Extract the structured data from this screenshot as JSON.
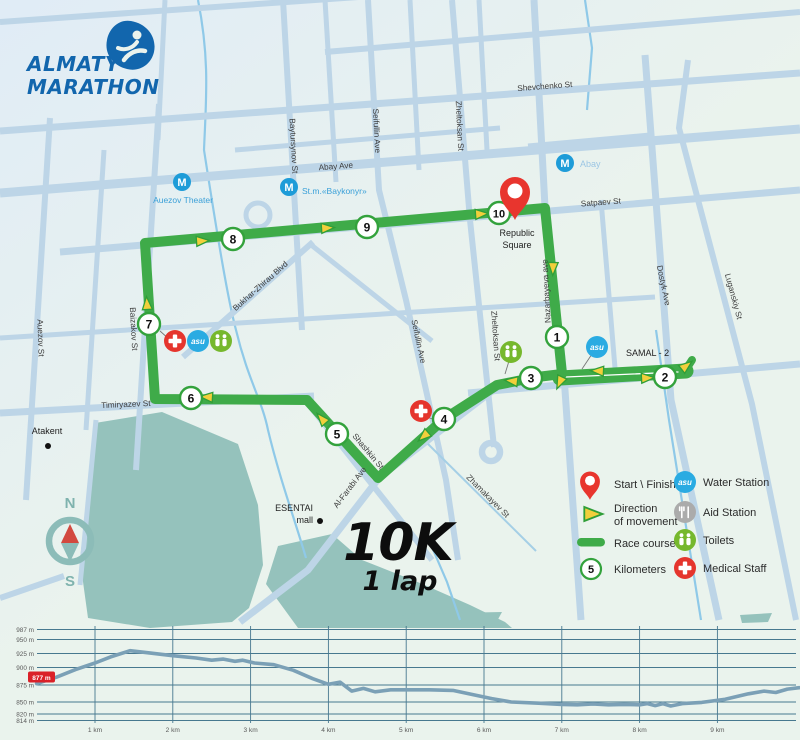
{
  "colors": {
    "background": "#eaf3ed",
    "background_tint": "#e2edf6",
    "street": "#bdd5e7",
    "river": "#8fc9e8",
    "park": "#95c2bc",
    "course_green": "#3fab49",
    "arrow_yellow": "#f2cf3b",
    "pin_red": "#e8352e",
    "medical_red": "#e5352d",
    "water_blue": "#2aabe2",
    "toilets_green": "#76b82d",
    "aid_gray": "#ababab",
    "metro_blue": "#1e9cd8",
    "logo_blue": "#1266ad",
    "chart_line": "#7ba0b6",
    "chart_grid": "#47788f"
  },
  "logo": {
    "line1": "ALMATY",
    "line2": "MARATHON"
  },
  "race": {
    "distance": "10K",
    "laps": "1 lap"
  },
  "compass": {
    "north": "N",
    "south": "S"
  },
  "icons": {
    "metro": "M",
    "asu": "asu"
  },
  "map": {
    "km_markers": [
      "1",
      "2",
      "3",
      "4",
      "5",
      "6",
      "7",
      "8",
      "9",
      "10"
    ],
    "start_area": {
      "line1": "Republic",
      "line2": "Square"
    },
    "streets": {
      "shevchenko": "Shevchenko St",
      "abay": "Abay Ave",
      "satpaev": "Satpaev St",
      "timiryazev": "Timiryazev St",
      "baytursynov": "Baytursynov St",
      "auezov": "Auezov St",
      "baizakov": "Baizakov St",
      "seifullin": "Seifullin Ave",
      "seifullin2": "Seifullin Ave",
      "zheltoksan": "Zheltoksan St",
      "zheltoksan2": "Zheltoksan St",
      "nazarbayeva": "Nazarbayeva ave",
      "dostyk": "Dostyk Ave",
      "luganskiy": "Luganskiy St",
      "bukhar_zhyrau": "Bukhar-Zhirau Blvd",
      "shashkin": "Shashkin St",
      "al_farabi": "Al-Farabi Ave",
      "zhamakayev": "Zhamakayev St"
    },
    "landmarks": {
      "auezov_theater": "Auezov Theater",
      "baykonyr": "St.m.«Baykonyr»",
      "abay_metro": "Abay",
      "atakent": "Atakent",
      "esentai_line1": "ESENTAI",
      "esentai_line2": "mall",
      "samal": "SAMAL - 2"
    }
  },
  "legend": {
    "start": "Start \\ Finish",
    "direction_line1": "Direction",
    "direction_line2": "of movement",
    "race_course": "Race course",
    "kilometers": "Kilometers",
    "km_sample": "5",
    "water": "Water Station",
    "aid": "Aid Station",
    "toilets": "Toilets",
    "medical": "Medical Staff"
  },
  "chart_data": {
    "type": "line",
    "xlabel": "distance, km",
    "ylabel": "elevation, m",
    "xticks": [
      1,
      2,
      3,
      4,
      5,
      6,
      7,
      8,
      9
    ],
    "xtick_labels": [
      "1 km",
      "2 km",
      "3 km",
      "4 km",
      "5 km",
      "6 km",
      "7 km",
      "8 km",
      "9 km"
    ],
    "yticks": [
      987,
      950,
      925,
      900,
      875,
      850,
      820,
      814
    ],
    "ytick_labels": [
      "987 m",
      "950 m",
      "925 m",
      "900 m",
      "875 m",
      "850 m",
      "820 m",
      "814 m"
    ],
    "start_label": "877 m",
    "start_elevation": 877,
    "profile": [
      [
        0.25,
        877
      ],
      [
        0.5,
        886
      ],
      [
        0.75,
        897
      ],
      [
        1,
        908
      ],
      [
        1.2,
        919
      ],
      [
        1.45,
        930
      ],
      [
        1.7,
        926
      ],
      [
        2,
        921
      ],
      [
        2.3,
        917
      ],
      [
        2.5,
        913
      ],
      [
        2.65,
        915
      ],
      [
        2.8,
        911
      ],
      [
        2.9,
        913
      ],
      [
        3.05,
        908
      ],
      [
        3.3,
        905
      ],
      [
        3.55,
        896
      ],
      [
        3.8,
        884
      ],
      [
        4,
        876
      ],
      [
        4.15,
        879
      ],
      [
        4.3,
        866
      ],
      [
        4.45,
        870
      ],
      [
        4.6,
        865
      ],
      [
        4.8,
        868
      ],
      [
        5.3,
        868
      ],
      [
        5.6,
        867
      ],
      [
        5.85,
        861
      ],
      [
        6.1,
        855
      ],
      [
        6.35,
        850
      ],
      [
        6.7,
        847
      ],
      [
        7,
        844
      ],
      [
        7.2,
        843
      ],
      [
        7.4,
        845
      ],
      [
        7.6,
        843
      ],
      [
        7.8,
        844
      ],
      [
        8,
        843
      ],
      [
        8.1,
        846
      ],
      [
        8.2,
        841
      ],
      [
        8.3,
        846
      ],
      [
        8.4,
        840
      ],
      [
        8.55,
        846
      ],
      [
        8.8,
        849
      ],
      [
        9.1,
        854
      ],
      [
        9.4,
        862
      ],
      [
        9.6,
        866
      ],
      [
        9.75,
        864
      ],
      [
        9.9,
        869
      ],
      [
        10.05,
        871
      ]
    ]
  }
}
